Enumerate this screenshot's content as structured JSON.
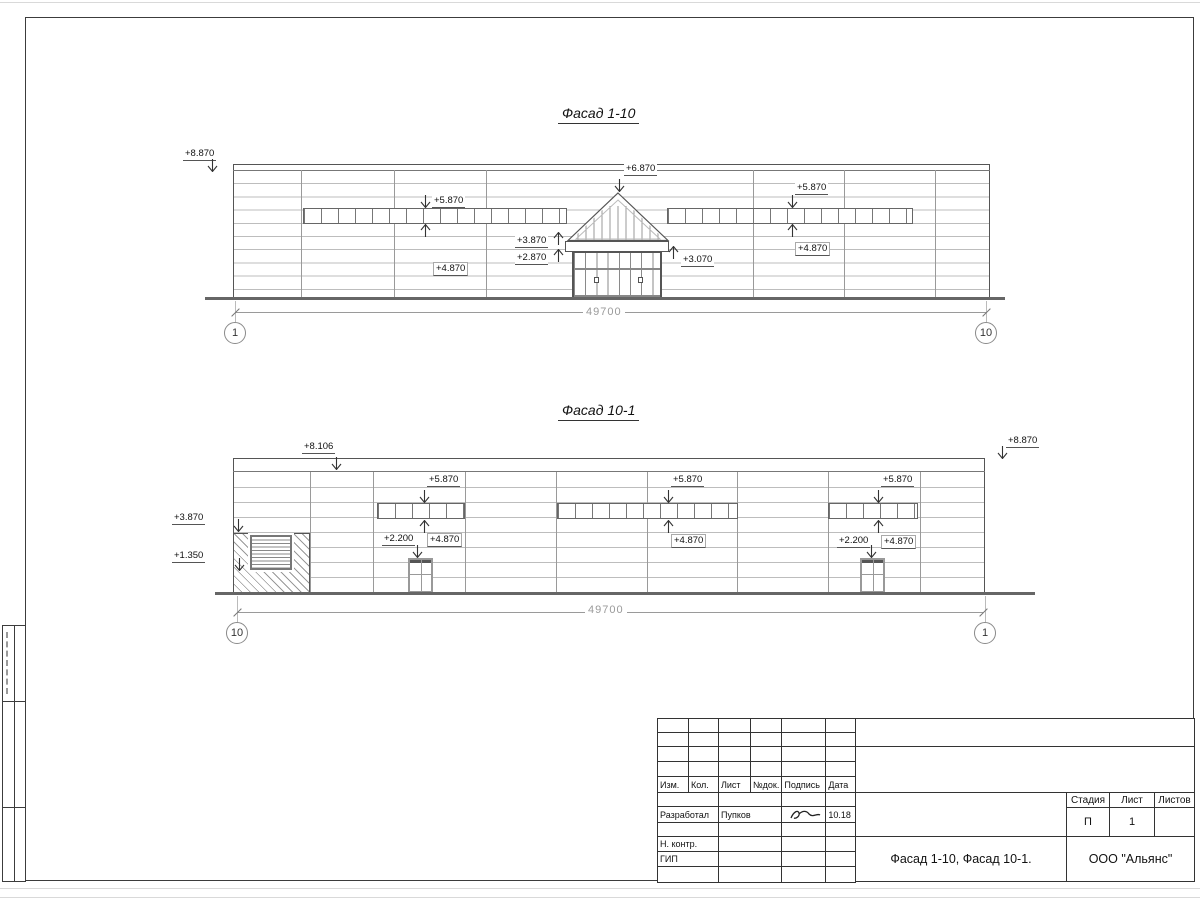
{
  "facade1": {
    "title": "Фасад 1-10",
    "dim_total": "49700",
    "axis_start": "1",
    "axis_end": "10",
    "levels": {
      "parapet": "+8.870",
      "win_top_left": "+5.870",
      "win_bottom_left": "+4.870",
      "canopy_apex": "+6.870",
      "canopy_top": "+3.870",
      "canopy_bottom": "+2.870",
      "canopy_right": "+3.070",
      "win_top_right": "+5.870",
      "win_bottom_right": "+4.870"
    }
  },
  "facade2": {
    "title": "Фасад 10-1",
    "dim_total": "49700",
    "axis_start": "10",
    "axis_end": "1",
    "levels": {
      "parapet_left": "+8.106",
      "parapet_right": "+8.870",
      "hatch_top": "+3.870",
      "louver_bottom": "+1.350",
      "win1_top": "+5.870",
      "win1_bottom": "+4.870",
      "door1_top": "+2.200",
      "win2_top": "+5.870",
      "win2_bottom": "+4.870",
      "win3_top": "+5.870",
      "win3_bottom": "+4.870",
      "door2_top": "+2.200"
    }
  },
  "titleblock": {
    "cols": [
      "Изм.",
      "Кол.",
      "Лист",
      "№док.",
      "Подпись",
      "Дата"
    ],
    "razrabotal": "Разработал",
    "razrabotal_name": "Пупков",
    "razrabotal_date": "10.18",
    "nkontr": "Н. контр.",
    "gip": "ГИП",
    "doc_title": "Фасад 1-10, Фасад 10-1.",
    "company": "ООО \"Альянс\"",
    "stage_cols": [
      "Стадия",
      "Лист",
      "Листов"
    ],
    "stage": "П",
    "sheet_num": "1",
    "sheets_total": ""
  }
}
